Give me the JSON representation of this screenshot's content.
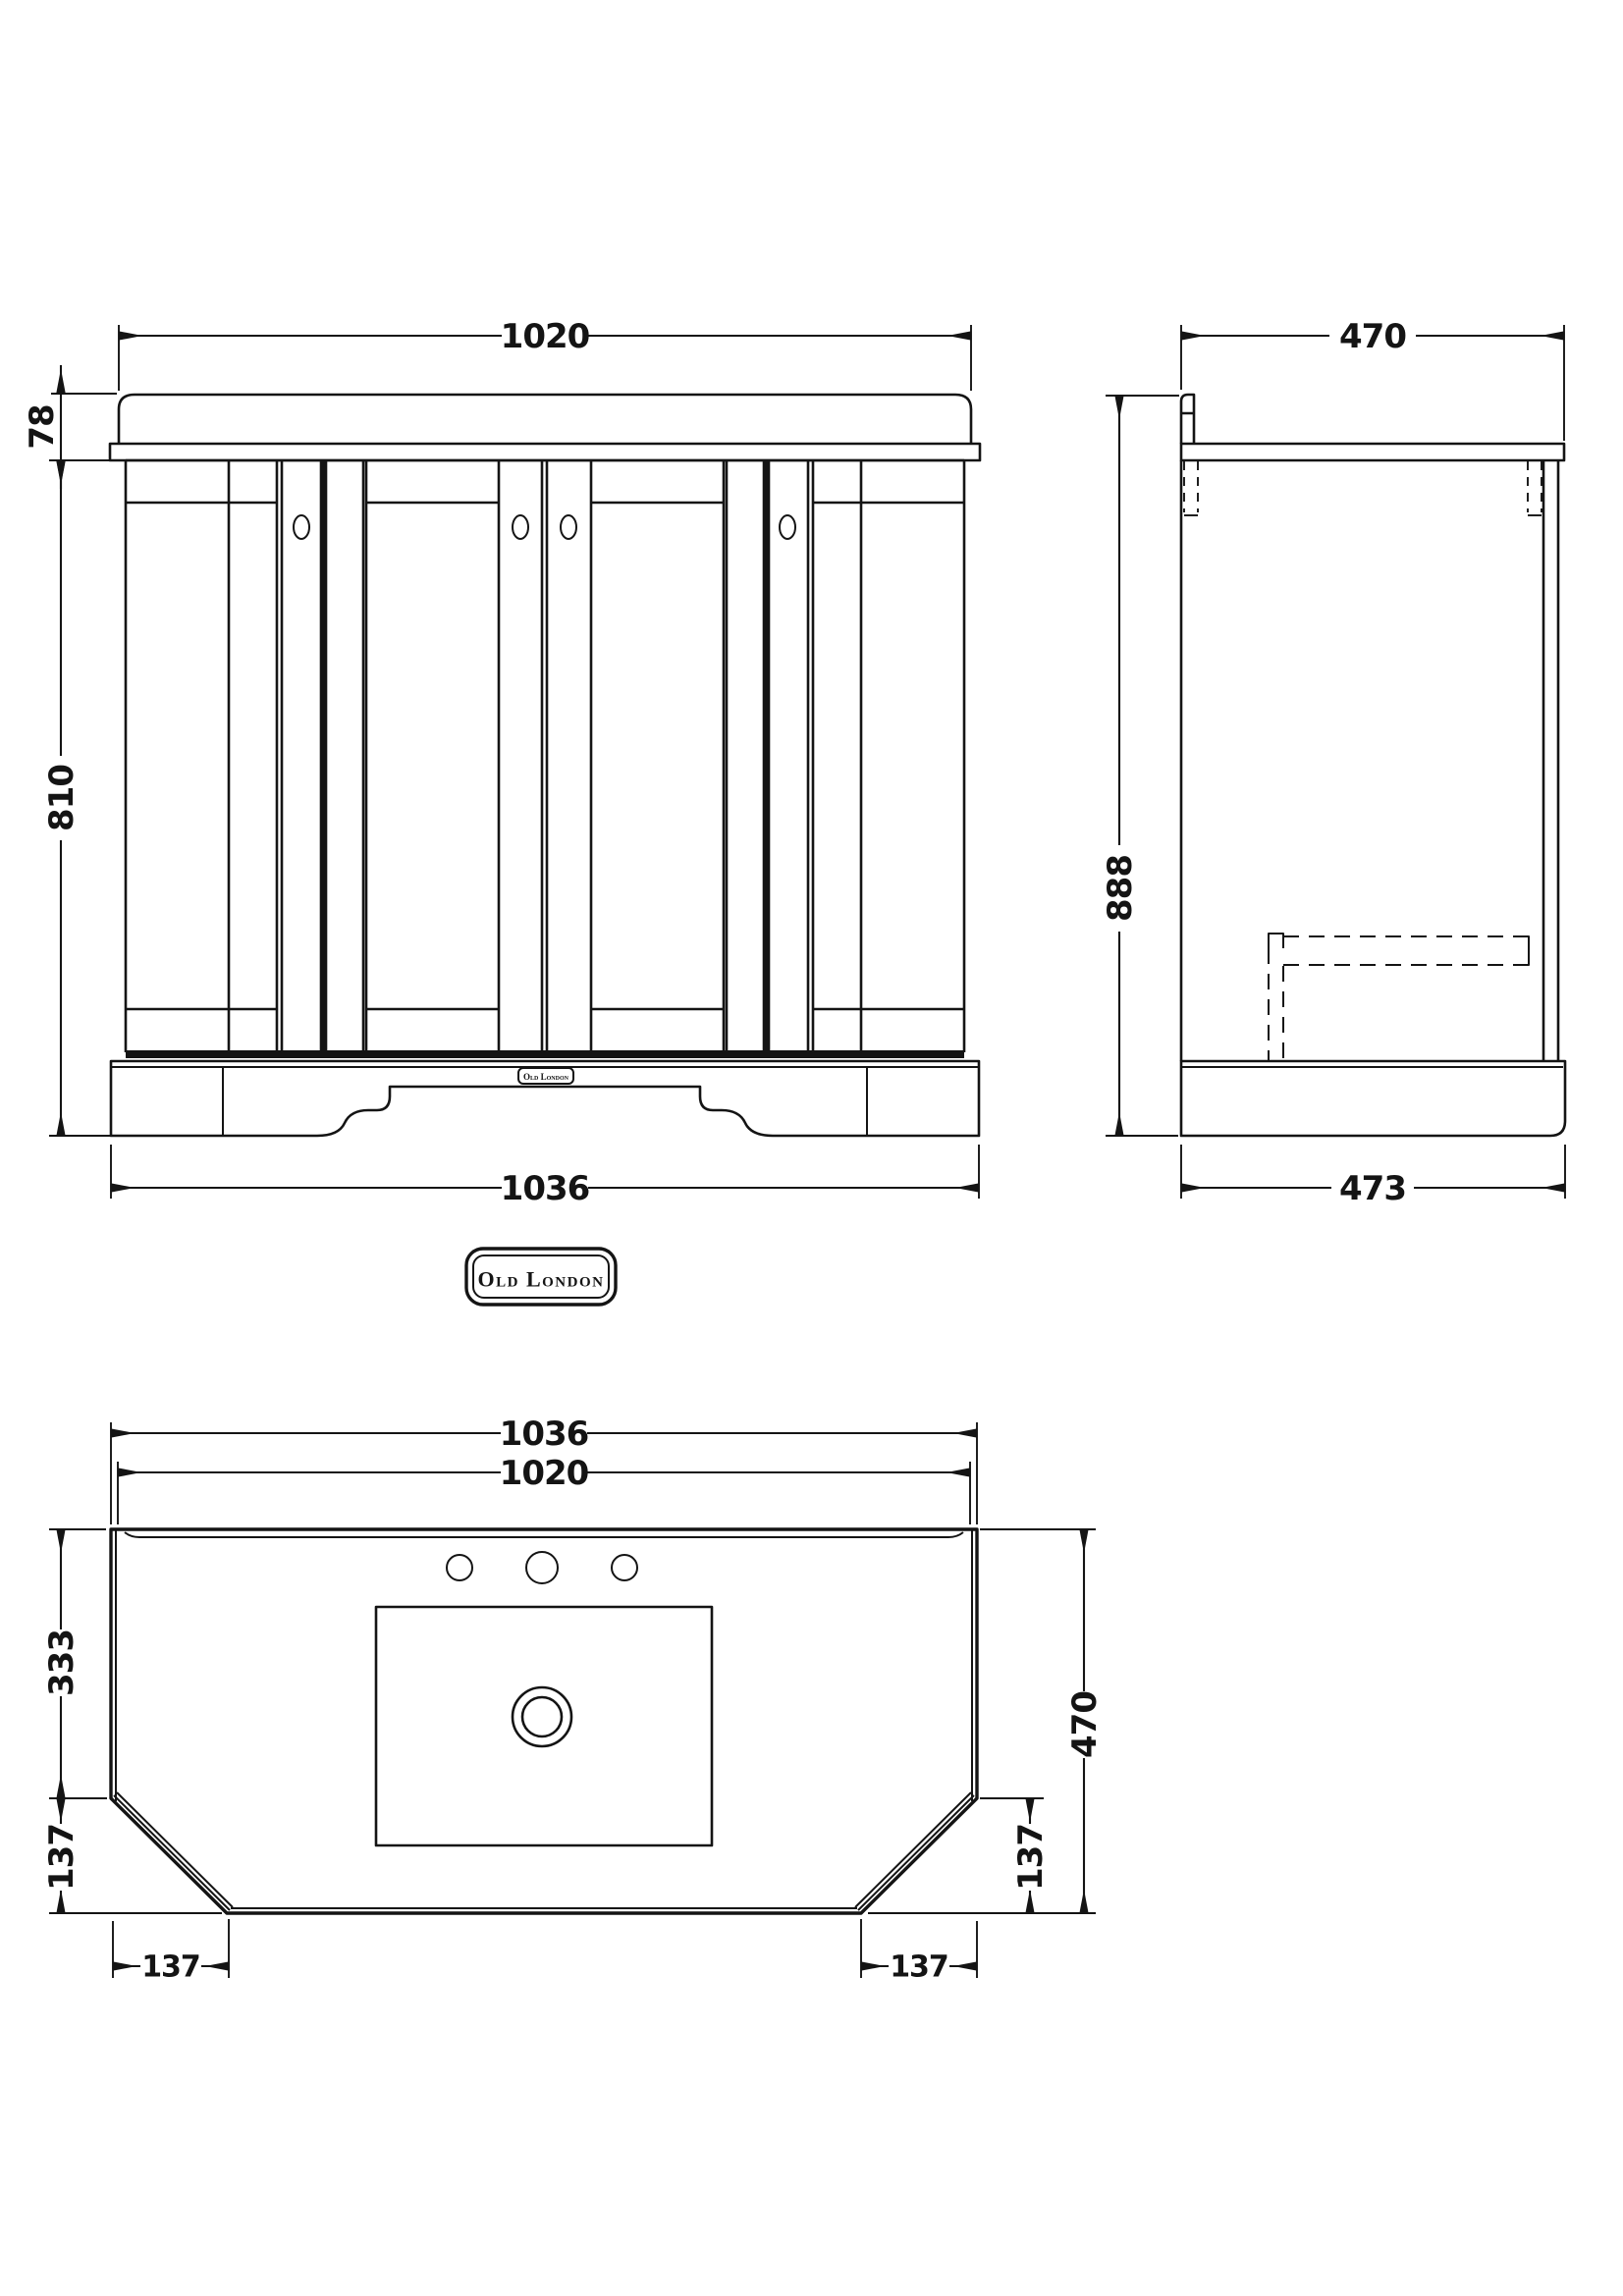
{
  "drawing": {
    "product": "Old London vanity unit technical drawing",
    "ink_color": "#141414",
    "background_color": "#ffffff"
  },
  "front_view": {
    "dims": {
      "top_width": "1020",
      "worktop_height": "78",
      "cabinet_height": "810",
      "base_width": "1036"
    },
    "badge_text": "Old London"
  },
  "side_view": {
    "dims": {
      "top_depth": "470",
      "total_height": "888",
      "base_depth": "473"
    }
  },
  "logo": {
    "text": "Old London"
  },
  "plan_view": {
    "dims": {
      "outer_width": "1036",
      "inner_width": "1020",
      "back_depth": "333",
      "chamfer_depth_left": "137",
      "chamfer_width_left": "137",
      "total_depth": "470",
      "chamfer_depth_right": "137",
      "chamfer_width_right": "137"
    }
  }
}
